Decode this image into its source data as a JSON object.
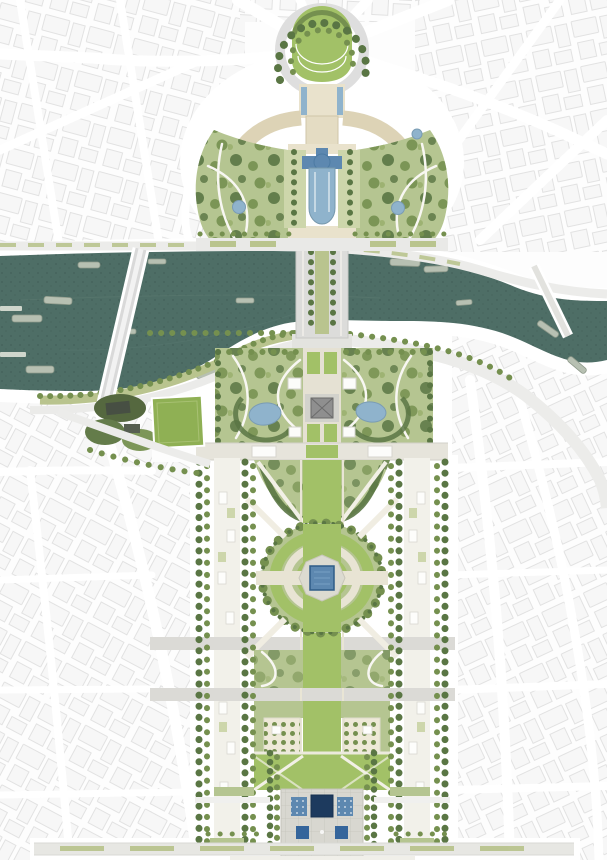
{
  "document": {
    "type": "architectural-masterplan-site-plan",
    "subject": "riverfront urban axis masterplan: palace gardens and fountain at top, river with bridges, tower park, long parade-ground park with grand oval and square pool, military-school forecourt with water basins at bottom, surrounded by pale city fabric",
    "orientation": "portrait",
    "visible_text": ""
  },
  "canvas": {
    "width": 607,
    "height": 860
  },
  "palette": {
    "bg": "#fdfdfd",
    "white": "#ffffff",
    "city_fill": "#f7f7f7",
    "city_stroke": "#e2e2e2",
    "river": "#4e6e66",
    "river_speck": "#3a564f",
    "pool": "#8fb3cc",
    "pool_deep": "#5d88b0",
    "pool_navy": "#1d3a5e",
    "pool_mid": "#35659b",
    "lawn_bright": "#a2c167",
    "lawn_mid": "#b5c591",
    "lawn_pale": "#cdd6ab",
    "olive": "#b9c48e",
    "tree_dark": "#5a7644",
    "tree_mid": "#75904f",
    "tree_light": "#9ab06e",
    "parvis": "#e9e2cc",
    "parvis_dark": "#ddd3b6",
    "path_beige": "#e7e3d2",
    "road": "#e9e9e7",
    "road_mid": "#d9d9d6",
    "plaza": "#d8d7d0",
    "tower": "#8f8f8f",
    "pitch": "#8fb054",
    "grove": "#55683f",
    "boat": "#b7c0b2",
    "boat_stroke": "#8e998a"
  },
  "features": {
    "list": [
      "city-fabric",
      "radial-avenues",
      "seine-river",
      "river-barges",
      "bir-hakeim-bridge",
      "iena-bridge",
      "debilly-footbridge",
      "upper-quay-road",
      "lower-quay-road",
      "trocadero-place",
      "chaillot-palace",
      "parvis-pools",
      "warsaw-fountain-basin",
      "trocadero-garden-west",
      "trocadero-garden-east",
      "garden-ponds",
      "riverside-sports-field",
      "riverside-tree-grove",
      "tower-park",
      "eiffel-tower-footprint",
      "tower-park-ponds",
      "bouvard-band",
      "champ-de-mars-allees",
      "champ-central-lawn",
      "grand-oval",
      "central-square-pool",
      "transverse-roads",
      "bosquets",
      "lawn-panels",
      "military-school-forecourt",
      "forecourt-pools",
      "bottom-boulevard"
    ]
  }
}
